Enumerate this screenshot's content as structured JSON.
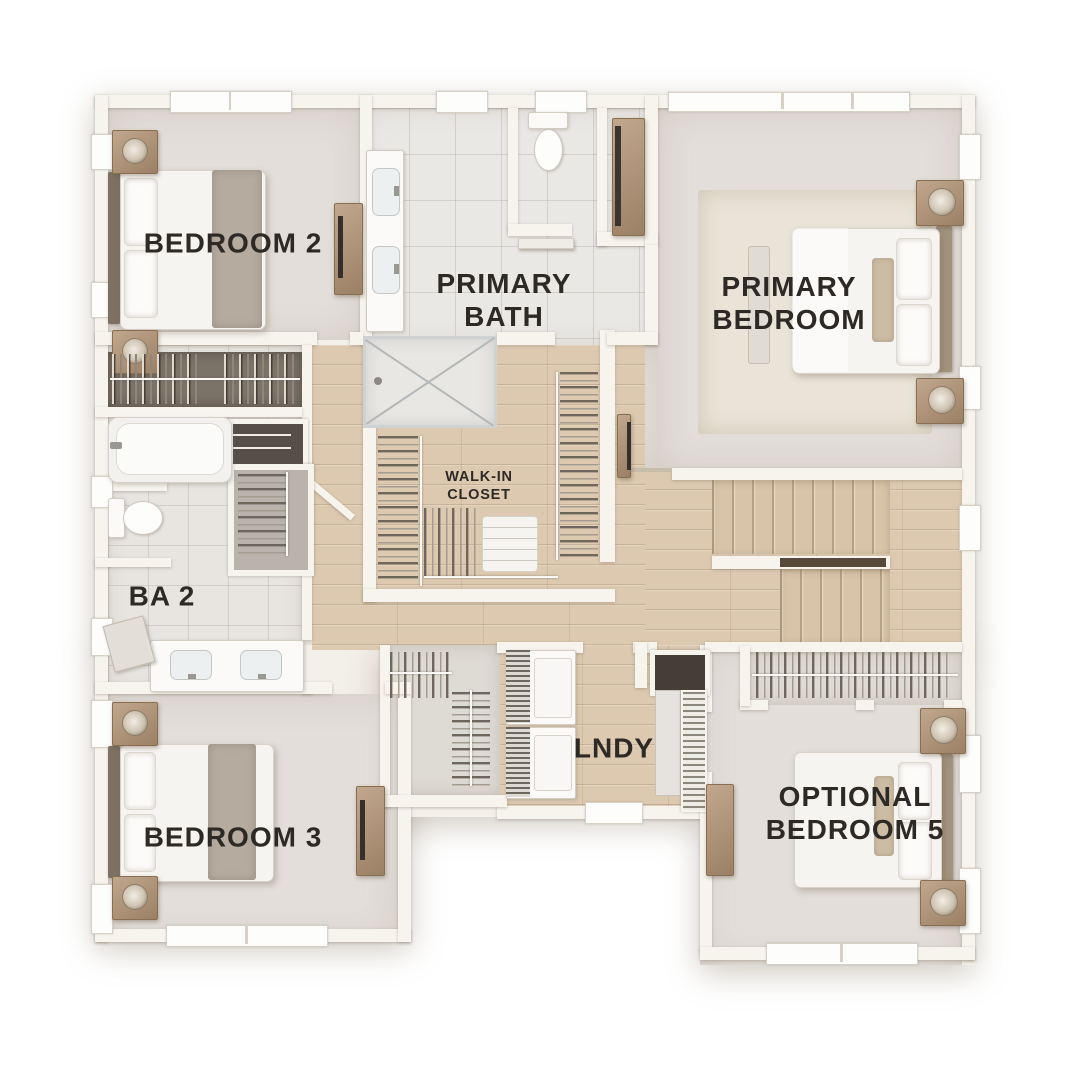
{
  "page": {
    "background": "#ffffff"
  },
  "plan": {
    "kind": "residential-floor-plan",
    "palette": {
      "wall": "#f7f4ee",
      "carpet": "#e3deda",
      "bath_tile": "#eae8e5",
      "wood_floor": "#dcc9b0",
      "closet_floor": "#dedad4",
      "dark_closet_floor": "#7b7268",
      "furniture_wood": "#ab9078",
      "fixture_white": "#fbfaf8",
      "textile_gray": "#b5ab9f",
      "accent_pillow": "#cdbca4",
      "label_text": "#2d2a26"
    },
    "rooms": [
      {
        "id": "bedroom-2",
        "lines": [
          "BEDROOM 2"
        ]
      },
      {
        "id": "primary-bath",
        "lines": [
          "PRIMARY",
          "BATH"
        ]
      },
      {
        "id": "primary-bedroom",
        "lines": [
          "PRIMARY",
          "BEDROOM"
        ]
      },
      {
        "id": "walk-in-closet",
        "lines": [
          "WALK-IN",
          "CLOSET"
        ]
      },
      {
        "id": "bath-2",
        "lines": [
          "BA 2"
        ]
      },
      {
        "id": "laundry",
        "lines": [
          "LNDY"
        ]
      },
      {
        "id": "bedroom-3",
        "lines": [
          "BEDROOM 3"
        ]
      },
      {
        "id": "optional-bedroom-5",
        "lines": [
          "OPTIONAL",
          "BEDROOM 5"
        ]
      }
    ]
  }
}
